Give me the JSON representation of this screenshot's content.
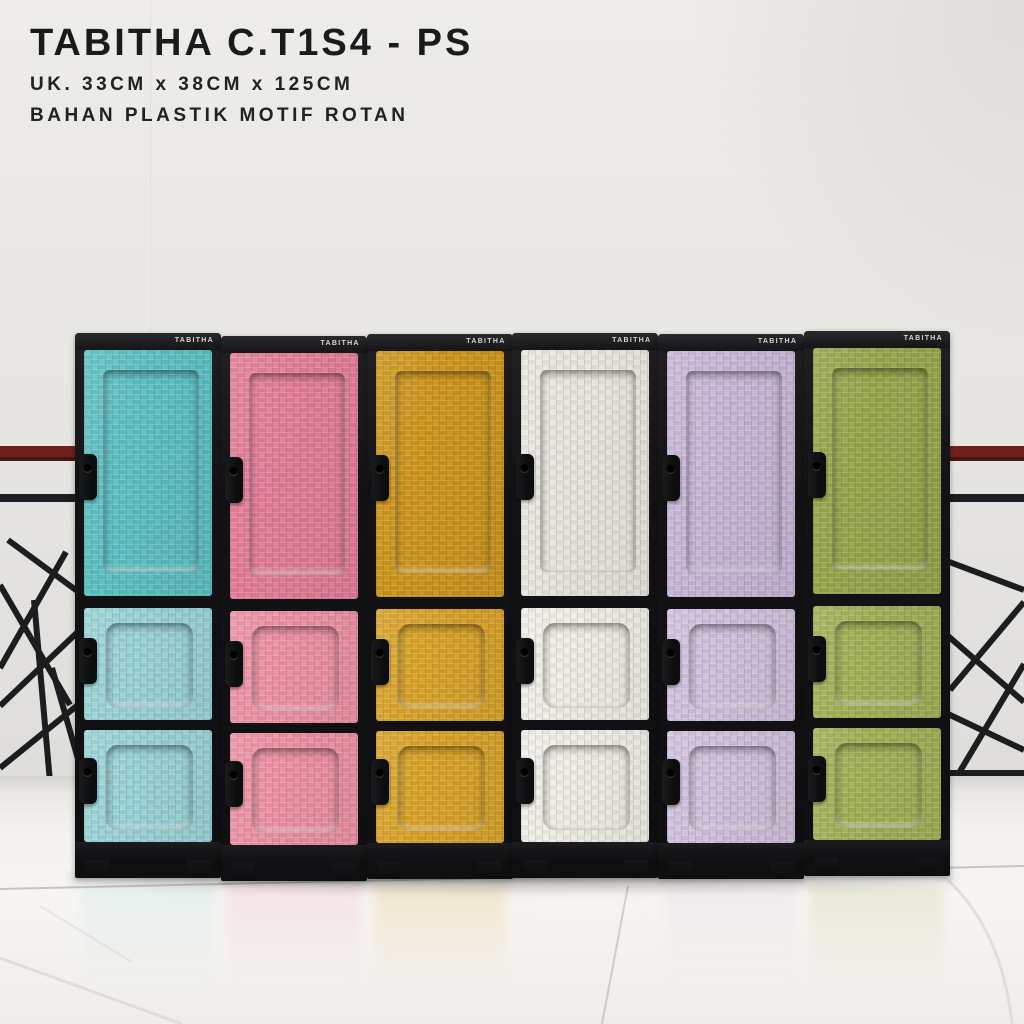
{
  "header": {
    "title": "TABITHA C.T1S4 - PS",
    "size_line": "UK. 33CM x 38CM x 125CM",
    "material_line": "BAHAN PLASTIK MOTIF ROTAN"
  },
  "brand_label": "TABITHA",
  "product": {
    "model": "C.T1S4 - PS",
    "doors_per_cabinet": 3,
    "cabinet_count": 6
  },
  "cabinets": [
    {
      "name": "tosca",
      "top_color": "#5fc2c5",
      "lower_color": "#9bd5d9"
    },
    {
      "name": "pink",
      "top_color": "#e5809a",
      "lower_color": "#ef93a7"
    },
    {
      "name": "mustard",
      "top_color": "#d0981f",
      "lower_color": "#dba52b"
    },
    {
      "name": "broken-white",
      "top_color": "#eae7df",
      "lower_color": "#f0eee7"
    },
    {
      "name": "lilac",
      "top_color": "#c9b8d7",
      "lower_color": "#d1c2dd"
    },
    {
      "name": "olive",
      "top_color": "#9aa84e",
      "lower_color": "#a4b259"
    }
  ],
  "scene": {
    "wall_color": "#e9e7e3",
    "floor_color": "#f4f2ef",
    "railing_red": "#6e211c",
    "railing_black": "#1d1d1f",
    "frame_black": "#141416",
    "handle_color": "#0f1012"
  }
}
